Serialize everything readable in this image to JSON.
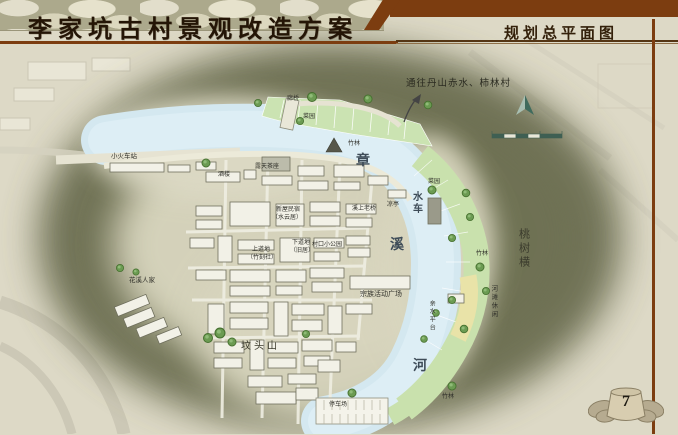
{
  "header": {
    "title_left": "李家坑古村景观改造方案",
    "title_right": "规划总平面图",
    "page_number": "7"
  },
  "colors": {
    "accent_brown": "#7c3d10",
    "river_blue": "#d4e8f0",
    "garden_green": "#cbe3b2",
    "beach_yellow": "#e9e3a8",
    "hill_olive": "#6e7152",
    "page_beige": "#ddd9c6"
  },
  "map": {
    "river_name": "章溪河",
    "labels": [
      {
        "t": "通往丹山赤水、柿林村",
        "x": 406,
        "y": 80,
        "fs": 9.5,
        "c": "note"
      },
      {
        "t": "小火车站",
        "x": 111,
        "y": 154,
        "fs": 6.5
      },
      {
        "t": "廊桥",
        "x": 287,
        "y": 96,
        "fs": 6
      },
      {
        "t": "菜园",
        "x": 303,
        "y": 114,
        "fs": 6
      },
      {
        "t": "竹林",
        "x": 348,
        "y": 141,
        "fs": 6
      },
      {
        "t": "露天茶座",
        "x": 255,
        "y": 164,
        "fs": 6
      },
      {
        "t": "酒楼",
        "x": 218,
        "y": 172,
        "fs": 6
      },
      {
        "t": "章",
        "x": 356,
        "y": 155,
        "fs": 14,
        "c": "river"
      },
      {
        "t": "菜园",
        "x": 428,
        "y": 179,
        "fs": 6
      },
      {
        "t": "水车",
        "x": 410,
        "y": 191,
        "fs": 10,
        "v": true,
        "c": "river2"
      },
      {
        "t": "凉亭",
        "x": 387,
        "y": 202,
        "fs": 6
      },
      {
        "t": "溪上老桥",
        "x": 352,
        "y": 206,
        "fs": 6
      },
      {
        "t": "新屋民宿",
        "x": 276,
        "y": 207,
        "fs": 6
      },
      {
        "t": "（水云居）",
        "x": 272,
        "y": 215,
        "fs": 6
      },
      {
        "t": "下道地",
        "x": 292,
        "y": 240,
        "fs": 6
      },
      {
        "t": "（旧居）",
        "x": 290,
        "y": 248,
        "fs": 6
      },
      {
        "t": "村口小公园",
        "x": 312,
        "y": 242,
        "fs": 6
      },
      {
        "t": "上道地",
        "x": 252,
        "y": 247,
        "fs": 6
      },
      {
        "t": "（竹刻社）",
        "x": 247,
        "y": 255,
        "fs": 6
      },
      {
        "t": "溪",
        "x": 390,
        "y": 239,
        "fs": 14,
        "c": "river"
      },
      {
        "t": "桃树横",
        "x": 517,
        "y": 228,
        "fs": 11,
        "v": true,
        "c": "area"
      },
      {
        "t": "竹林",
        "x": 476,
        "y": 251,
        "fs": 6
      },
      {
        "t": "河滩休闲",
        "x": 489,
        "y": 285,
        "fs": 6.5,
        "v": true
      },
      {
        "t": "宗族活动广场",
        "x": 360,
        "y": 291,
        "fs": 7
      },
      {
        "t": "亲水平台",
        "x": 428,
        "y": 300,
        "fs": 6,
        "v": true
      },
      {
        "t": "坟头山",
        "x": 241,
        "y": 342,
        "fs": 10,
        "c": "area"
      },
      {
        "t": "花溪人家",
        "x": 129,
        "y": 278,
        "fs": 6.5
      },
      {
        "t": "河",
        "x": 413,
        "y": 360,
        "fs": 14,
        "c": "river"
      },
      {
        "t": "停车场",
        "x": 329,
        "y": 402,
        "fs": 6
      },
      {
        "t": "竹林",
        "x": 442,
        "y": 394,
        "fs": 6
      }
    ]
  }
}
